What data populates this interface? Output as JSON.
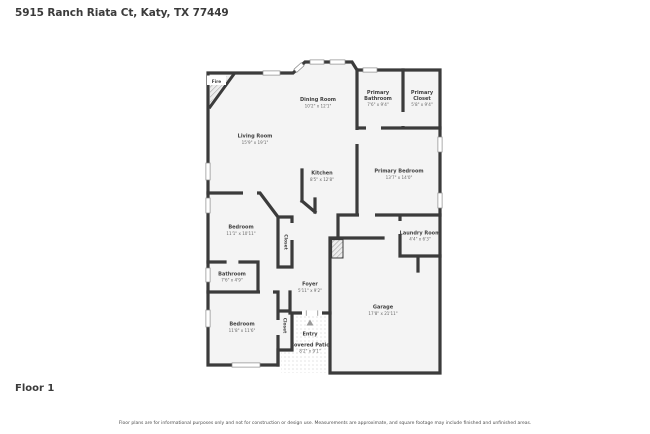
{
  "page": {
    "title": "5915 Ranch Riata Ct, Katy, TX 77449",
    "floor_label": "Floor 1",
    "disclaimer": "Floor plans are for informational purposes only and not for construction or design use. Measurements are approximate, and square footage may include finished and unfinished areas."
  },
  "colors": {
    "wall": "#3b3b3b",
    "room_fill": "#f4f4f4",
    "label_text": "#3f3f3f",
    "dim_text": "#686868",
    "background": "#ffffff"
  },
  "rooms": {
    "living_room": {
      "name": "Living Room",
      "dims": "15'9\" x 19'1\""
    },
    "dining_room": {
      "name": "Dining Room",
      "dims": "10'2\" x 12'1\""
    },
    "kitchen": {
      "name": "Kitchen",
      "dims": "8'5\" x 12'8\""
    },
    "primary_bathroom": {
      "name_line1": "Primary",
      "name_line2": "Bathroom",
      "dims": "7'6\" x 9'4\""
    },
    "primary_closet": {
      "name_line1": "Primary",
      "name_line2": "Closet",
      "dims": "5'8\" x 9'4\""
    },
    "primary_bedroom": {
      "name": "Primary Bedroom",
      "dims": "13'7\" x 14'0\""
    },
    "bedroom_1": {
      "name": "Bedroom",
      "dims": "11'1\" x 10'11\""
    },
    "closet_1": {
      "name": "Closet"
    },
    "laundry_room": {
      "name": "Laundry Room",
      "dims": "4'4\" x 6'3\""
    },
    "bathroom": {
      "name": "Bathroom",
      "dims": "7'6\" x 4'9\""
    },
    "foyer": {
      "name": "Foyer",
      "dims": "5'11\" x 9'2\""
    },
    "bedroom_2": {
      "name": "Bedroom",
      "dims": "11'8\" x 11'6\""
    },
    "closet_2": {
      "name": "Closet"
    },
    "entry": {
      "name": "Entry"
    },
    "covered_patio": {
      "name": "Covered Patio",
      "dims": "8'2\" x 9'1\""
    },
    "garage": {
      "name": "Garage",
      "dims": "17'8\" x 21'11\""
    },
    "fireplace": {
      "name": "Fire"
    }
  }
}
